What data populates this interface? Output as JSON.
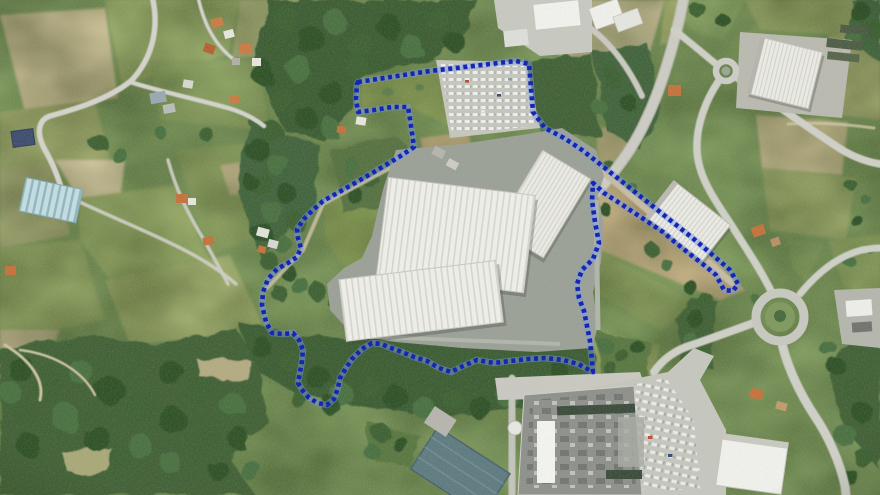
{
  "image": {
    "kind": "aerial-orthophoto-with-boundary-overlay",
    "width": 880,
    "height": 495
  },
  "overlay": {
    "boundary_style": "dotted",
    "dot_color": "#1626b0",
    "halo_color": "#7b9be6",
    "boundary_points": "358,82 430,71 516,61 529,64 533,112 545,128 564,138 582,150 596,161 620,180 645,200 670,220 695,240 715,257 730,270 738,284 733,291 724,290 716,275 704,265 691,255 676,243 663,232 648,222 633,212 618,202 604,193 593,183 592,200 595,222 599,243 593,259 582,270 577,284 579,298 584,311 587,326 590,341 592,361 593,372 578,364 563,360 545,358 528,359 510,361 494,363 477,360 463,366 451,372 439,368 427,361 414,357 402,352 391,348 381,344 372,343 362,349 352,359 346,368 340,378 338,388 334,399 327,405 318,403 309,398 303,391 298,383 300,372 302,361 303,350 299,340 293,333 283,334 272,333 266,322 262,305 263,292 268,279 277,269 288,263 297,257 301,248 298,238 297,229 304,219 313,210 323,201 348,187 374,172 399,157 414,147 412,133 410,119 408,107 392,107 374,110 358,112 356,99 357,84"
  },
  "palette": {
    "grass_base": "#7f9b5e",
    "forest": "#3a5c30",
    "tree_shades": [
      "#2e5128",
      "#3c6130",
      "#4a7040",
      "#5d7b4a"
    ],
    "road": "#cfd0c8",
    "apron": "#9aa096",
    "factory_roof": "#f0f0ea",
    "store_roof": "#8d908a",
    "teal_roof": "#5d7a80",
    "parking": "#c5c6be",
    "house_orange": "#c4713a",
    "navy_shed": "#3c4c6e"
  },
  "features": [
    "industrial-plant-white-ribbed-roof",
    "visitor-car-park",
    "north-service-yard",
    "northeast-warehouse",
    "top-right-warehouse",
    "small-roundabout",
    "large-roundabout",
    "retail-store-and-car-park",
    "teal-warehouse",
    "village-houses",
    "greenhouses",
    "farm-fields",
    "forest",
    "dotted-site-boundary"
  ],
  "trees": [
    [
      285,
      18,
      13,
      1
    ],
    [
      310,
      40,
      14,
      0
    ],
    [
      335,
      22,
      12,
      2
    ],
    [
      360,
      45,
      13,
      1
    ],
    [
      388,
      25,
      12,
      0
    ],
    [
      412,
      48,
      12,
      2
    ],
    [
      438,
      20,
      11,
      1
    ],
    [
      455,
      42,
      10,
      0
    ],
    [
      300,
      70,
      13,
      2
    ],
    [
      330,
      92,
      12,
      0
    ],
    [
      358,
      68,
      11,
      1
    ],
    [
      282,
      100,
      12,
      1
    ],
    [
      262,
      72,
      12,
      0
    ],
    [
      306,
      118,
      11,
      0
    ],
    [
      330,
      128,
      10,
      2
    ],
    [
      270,
      130,
      11,
      1
    ],
    [
      258,
      150,
      12,
      0
    ],
    [
      278,
      165,
      11,
      2
    ],
    [
      262,
      185,
      11,
      1
    ],
    [
      288,
      195,
      10,
      0
    ],
    [
      272,
      212,
      11,
      2
    ],
    [
      296,
      222,
      9,
      1
    ],
    [
      262,
      232,
      10,
      0
    ],
    [
      282,
      244,
      9,
      2
    ],
    [
      270,
      262,
      9,
      1
    ],
    [
      288,
      272,
      8,
      0
    ],
    [
      300,
      286,
      9,
      2
    ],
    [
      278,
      292,
      8,
      1
    ],
    [
      352,
      168,
      9,
      2
    ],
    [
      372,
      182,
      8,
      1
    ],
    [
      392,
      170,
      8,
      3
    ],
    [
      404,
      188,
      7,
      2
    ],
    [
      356,
      196,
      8,
      0
    ],
    [
      98,
      142,
      9,
      1
    ],
    [
      120,
      156,
      8,
      2
    ],
    [
      208,
      136,
      7,
      1
    ],
    [
      250,
      182,
      8,
      0
    ],
    [
      160,
      132,
      6,
      2
    ],
    [
      318,
      292,
      9,
      1
    ],
    [
      336,
      302,
      8,
      0
    ],
    [
      612,
      172,
      8,
      1
    ],
    [
      630,
      188,
      7,
      2
    ],
    [
      604,
      208,
      6,
      0
    ],
    [
      652,
      250,
      7,
      1
    ],
    [
      668,
      266,
      6,
      2
    ],
    [
      688,
      285,
      7,
      0
    ],
    [
      705,
      300,
      8,
      1
    ],
    [
      695,
      318,
      9,
      0
    ],
    [
      688,
      338,
      8,
      2
    ],
    [
      704,
      352,
      8,
      1
    ],
    [
      756,
      300,
      5,
      2
    ],
    [
      780,
      316,
      6,
      0
    ],
    [
      852,
      186,
      6,
      1
    ],
    [
      866,
      200,
      5,
      2
    ],
    [
      858,
      222,
      6,
      0
    ],
    [
      872,
      250,
      5,
      1
    ],
    [
      850,
      262,
      6,
      2
    ],
    [
      860,
      12,
      10,
      0
    ],
    [
      874,
      30,
      9,
      1
    ],
    [
      856,
      40,
      8,
      2
    ],
    [
      700,
      12,
      8,
      1
    ],
    [
      722,
      20,
      7,
      0
    ],
    [
      612,
      78,
      9,
      1
    ],
    [
      628,
      102,
      8,
      0
    ],
    [
      600,
      108,
      8,
      2
    ],
    [
      262,
      348,
      10,
      0
    ],
    [
      290,
      362,
      11,
      1
    ],
    [
      318,
      378,
      12,
      0
    ],
    [
      342,
      394,
      11,
      2
    ],
    [
      368,
      386,
      10,
      1
    ],
    [
      396,
      398,
      12,
      0
    ],
    [
      424,
      408,
      11,
      2
    ],
    [
      452,
      398,
      10,
      1
    ],
    [
      480,
      408,
      11,
      0
    ],
    [
      508,
      396,
      12,
      2
    ],
    [
      536,
      388,
      10,
      1
    ],
    [
      560,
      372,
      9,
      0
    ],
    [
      578,
      390,
      10,
      2
    ],
    [
      300,
      398,
      10,
      1
    ],
    [
      330,
      405,
      9,
      0
    ],
    [
      20,
      368,
      13,
      0
    ],
    [
      48,
      388,
      14,
      1
    ],
    [
      80,
      372,
      12,
      2
    ],
    [
      110,
      390,
      14,
      0
    ],
    [
      140,
      408,
      13,
      1
    ],
    [
      66,
      418,
      14,
      2
    ],
    [
      24,
      412,
      12,
      1
    ],
    [
      96,
      438,
      13,
      0
    ],
    [
      140,
      446,
      12,
      2
    ],
    [
      170,
      372,
      12,
      0
    ],
    [
      200,
      390,
      13,
      1
    ],
    [
      232,
      404,
      12,
      2
    ],
    [
      172,
      420,
      13,
      0
    ],
    [
      208,
      436,
      12,
      1
    ],
    [
      240,
      440,
      11,
      0
    ],
    [
      120,
      458,
      12,
      1
    ],
    [
      170,
      462,
      11,
      2
    ],
    [
      28,
      444,
      12,
      0
    ],
    [
      10,
      392,
      11,
      2
    ],
    [
      218,
      470,
      10,
      0
    ],
    [
      250,
      470,
      10,
      2
    ],
    [
      90,
      420,
      12,
      1
    ],
    [
      836,
      366,
      9,
      0
    ],
    [
      852,
      388,
      10,
      1
    ],
    [
      862,
      412,
      10,
      0
    ],
    [
      846,
      436,
      11,
      2
    ],
    [
      864,
      458,
      10,
      1
    ],
    [
      850,
      478,
      9,
      0
    ],
    [
      826,
      346,
      8,
      2
    ],
    [
      606,
      346,
      8,
      2
    ],
    [
      622,
      356,
      7,
      1
    ],
    [
      638,
      348,
      7,
      0
    ],
    [
      610,
      368,
      7,
      1
    ],
    [
      380,
      432,
      9,
      1
    ],
    [
      400,
      444,
      8,
      0
    ],
    [
      372,
      452,
      8,
      2
    ],
    [
      388,
      92,
      5,
      3
    ],
    [
      420,
      88,
      4,
      3
    ],
    [
      448,
      100,
      4,
      3
    ],
    [
      500,
      80,
      5,
      3
    ],
    [
      470,
      70,
      4,
      3
    ]
  ]
}
